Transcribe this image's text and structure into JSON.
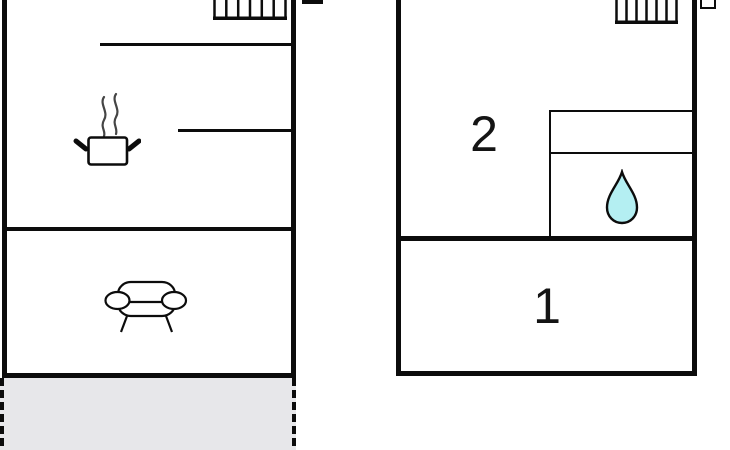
{
  "diagram": {
    "type": "floorplan",
    "background": "#ffffff",
    "wall_color": "#0c0c0c"
  },
  "left_unit": {
    "stairs_icon": "stairs-icon",
    "kitchen_icon": "cooking-pot-icon",
    "steam_icon": "steam-icon",
    "living_icon": "sofa-icon",
    "terrace_fill": "#e7e7ea"
  },
  "right_unit": {
    "stairs_icon": "stairs-icon",
    "bathroom_icon": "water-drop-icon",
    "water_drop_fill": "#b4eff2",
    "rooms": [
      {
        "label": "2"
      },
      {
        "label": "1"
      }
    ]
  }
}
